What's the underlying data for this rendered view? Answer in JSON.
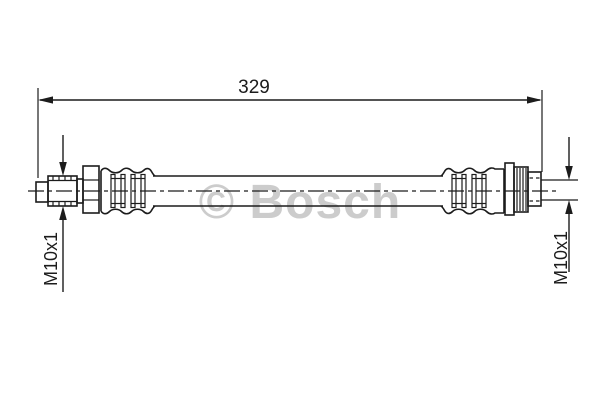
{
  "colors": {
    "background": "#ffffff",
    "line": "#1c1c1c",
    "watermark": "#cccccc"
  },
  "watermark": {
    "text": "© Bosch"
  },
  "dimensions": {
    "overall_length": "329",
    "left_thread": "M10x1",
    "right_thread": "M10x1"
  }
}
